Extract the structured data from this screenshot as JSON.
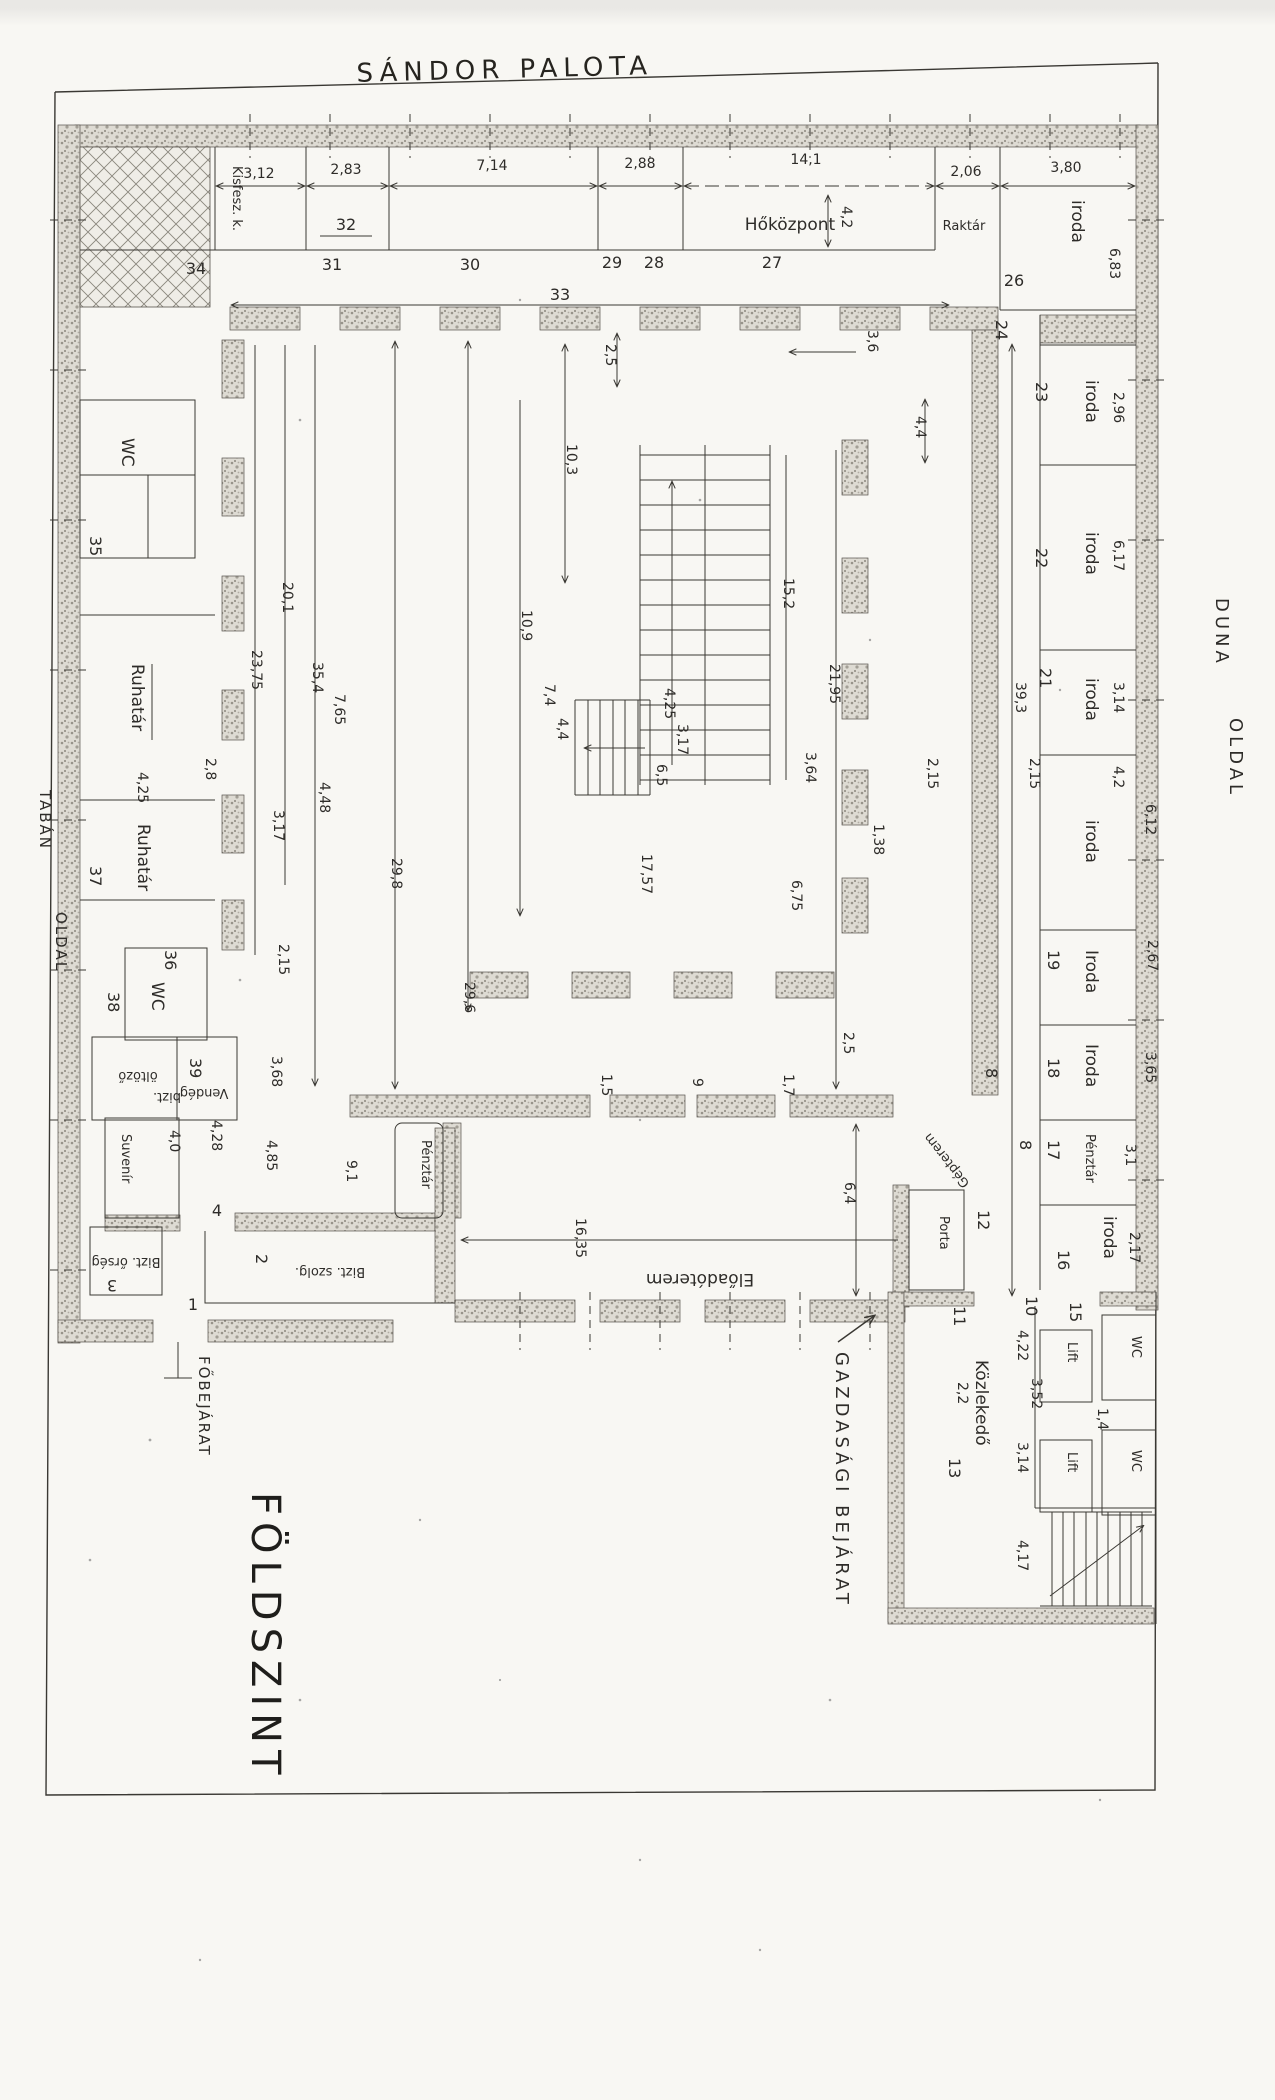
{
  "texts": {
    "title": "SÁNDOR PALOTA",
    "floor": "FÖLDSZINT",
    "main_entrance": "FŐBEJÁRAT",
    "economic_entrance": "GAZDASÁGI BEJÁRAT",
    "side_left_1": "TABÁN",
    "side_left_2": "OLDAL",
    "side_right_1": "DUNA",
    "side_right_2": "OLDAL"
  },
  "rooms": {
    "kisfesz": "Kisfesz. k.",
    "hokozpont": "Hőközpont",
    "raktar": "Raktár",
    "iroda": "iroda",
    "iroda_cap": "Iroda",
    "penztar": "Pénztár",
    "wc": "WC",
    "ruhatar": "Ruhatár",
    "oltozo": "öltöző",
    "bizt": "bizt.",
    "vendeg": "Vendég",
    "suvenir": "Suvenír",
    "bizt_orseg": "Bizt. őrség",
    "bizt_szolg": "Bizt. szolg.",
    "porta": "Porta",
    "gepterem": "Gépterem",
    "eloadoterem": "Előadóterem",
    "kozlekedo": "Közlekedő",
    "lift": "Lift"
  },
  "numbers": {
    "n34": "34",
    "n32": "32",
    "n31": "31",
    "n30": "30",
    "n29": "29",
    "n28": "28",
    "n27": "27",
    "n26": "26",
    "n24": "24",
    "n23": "23",
    "n22": "22",
    "n21": "21",
    "n19": "19",
    "n18": "18",
    "n17": "17",
    "n16": "16",
    "n15": "15",
    "n35": "35",
    "n37": "37",
    "n36": "36",
    "n38": "38",
    "n39": "39",
    "n1": "1",
    "n2": "2",
    "n3": "3",
    "n4": "4",
    "n8a": "8",
    "n8b": "8",
    "n10": "10",
    "n11": "11",
    "n12": "12",
    "n13": "13"
  },
  "dims": {
    "t1": "3,12",
    "t2": "2,83",
    "t3": "7,14",
    "t4": "2,88",
    "t5": "14,1",
    "t6": "2,06",
    "t7": "3,80",
    "t33": "33",
    "t42": "4,2",
    "t683": "6,83",
    "r296": "2,96",
    "r617": "6,17",
    "r314": "3,14",
    "r42": "4,2",
    "r612": "6,12",
    "r267": "2,67",
    "r365": "3,65",
    "r31": "3,1",
    "r217": "2,17",
    "r393": "39,3",
    "r215": "2,15",
    "c36": "3,6",
    "c44": "4,4",
    "c25": "2,5",
    "c103": "10,3",
    "c109": "10,9",
    "c74": "7,4",
    "c152": "15,2",
    "c2195": "21,95",
    "c44b": "4,4",
    "c425": "4,25",
    "c317": "3,17",
    "c65": "6,5",
    "c364": "3,64",
    "c215": "2,15",
    "c138": "1,38",
    "c1757": "17,57",
    "c675": "6,75",
    "c298": "29,8",
    "c296": "29,6",
    "l2375": "23,75",
    "l201": "20,1",
    "l354": "35,4",
    "l765": "7,65",
    "l28": "2,8",
    "l317": "3,17",
    "l448": "4,48",
    "l425": "4,25",
    "l215": "2,15",
    "l368": "3,68",
    "l428": "4,28",
    "l485": "4,85",
    "l40": "4,0",
    "l91": "9,1",
    "b25": "2,5",
    "b17": "1,7",
    "b15": "1,5",
    "b9": "9",
    "b64": "6,4",
    "b1635": "16,35",
    "a422": "4,22",
    "a352": "3,52",
    "a22": "2,2",
    "a14": "1,4",
    "a314": "3,14",
    "a417": "4,17"
  }
}
